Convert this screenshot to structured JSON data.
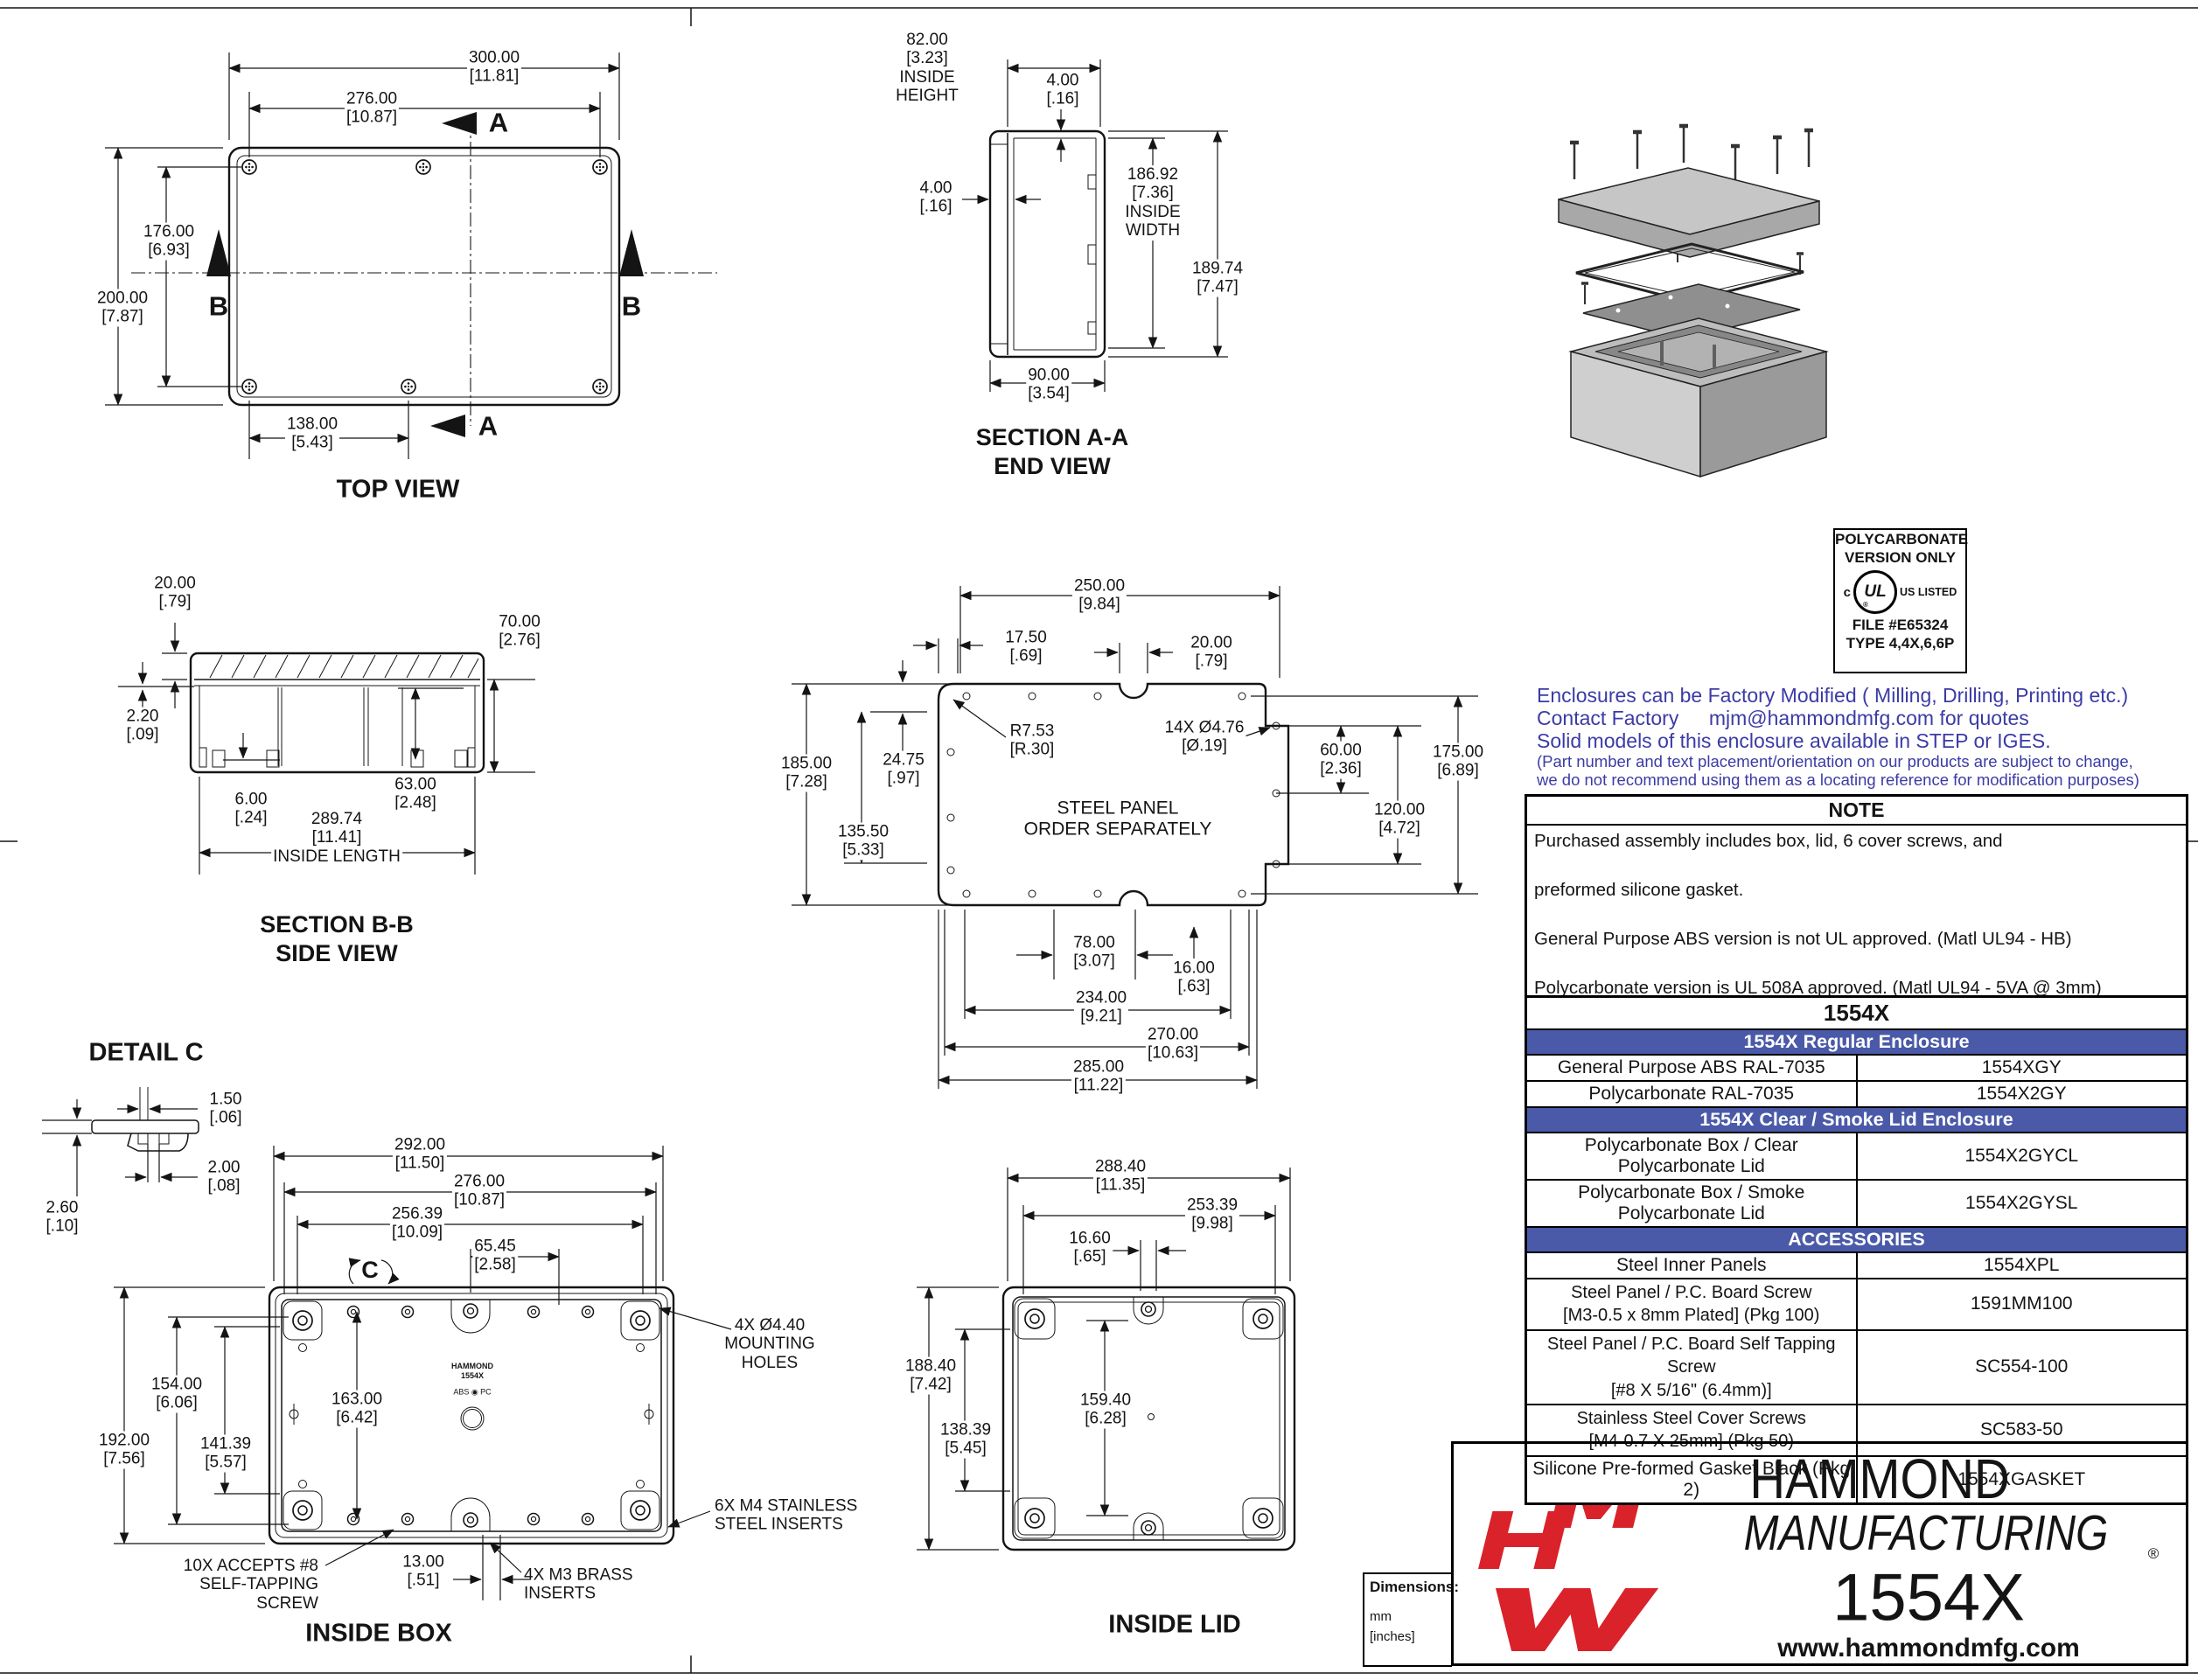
{
  "colors": {
    "line": "#141414",
    "table_header_blue": "#4a5aa8",
    "factory_text_blue": "#3b3ba6",
    "logo_red": "#d9222a"
  },
  "top_view": {
    "label": "TOP VIEW",
    "mark_a": "A",
    "mark_b": "B",
    "dim_300": "300.00\n[11.81]",
    "dim_276": "276.00\n[10.87]",
    "dim_200": "200.00\n[7.87]",
    "dim_176": "176.00\n[6.93]",
    "dim_138": "138.00\n[5.43]"
  },
  "section_aa": {
    "label1": "SECTION A-A",
    "label2": "END VIEW",
    "dim_inside_height": "82.00\n[3.23]\nINSIDE\nHEIGHT",
    "dim_wall_top": "4.00\n[.16]",
    "dim_wall_side": "4.00\n[.16]",
    "dim_inside_width": "186.92\n[7.36]\nINSIDE\nWIDTH",
    "dim_overall_width": "189.74\n[7.47]",
    "dim_depth": "90.00\n[3.54]"
  },
  "section_bb": {
    "label1": "SECTION B-B",
    "label2": "SIDE VIEW",
    "dim_lid": "20.00\n[.79]",
    "dim_gasket": "2.20\n[.09]",
    "dim_box_height": "70.00\n[2.76]",
    "dim_floor": "6.00\n[.24]",
    "dim_inner_height": "63.00\n[2.48]",
    "dim_inside_length": "289.74\n[11.41]\nINSIDE LENGTH"
  },
  "steel_panel": {
    "note": "STEEL PANEL\nORDER SEPARATELY",
    "dim_250": "250.00\n[9.84]",
    "dim_17_5": "17.50\n[.69]",
    "dim_20": "20.00\n[.79]",
    "dim_radius": "R7.53\n[R.30]",
    "dim_holes": "14X Ø4.76\n[Ø.19]",
    "dim_185": "185.00\n[7.28]",
    "dim_24_75": "24.75\n[.97]",
    "dim_135_5": "135.50\n[5.33]",
    "dim_60": "60.00\n[2.36]",
    "dim_175": "175.00\n[6.89]",
    "dim_120": "120.00\n[4.72]",
    "dim_78": "78.00\n[3.07]",
    "dim_16": "16.00\n[.63]",
    "dim_234": "234.00\n[9.21]",
    "dim_270": "270.00\n[10.63]",
    "dim_285": "285.00\n[11.22]"
  },
  "detail_c": {
    "label": "DETAIL  C",
    "dim_1_5": "1.50\n[.06]",
    "dim_2": "2.00\n[.08]",
    "dim_2_6": "2.60\n[.10]"
  },
  "inside_box": {
    "label": "INSIDE BOX",
    "mark_c": "C",
    "brand": "HAMMOND\n1554X",
    "material": "ABS ◉ PC",
    "dim_292": "292.00\n[11.50]",
    "dim_276": "276.00\n[10.87]",
    "dim_256": "256.39\n[10.09]",
    "dim_65": "65.45\n[2.58]",
    "dim_154": "154.00\n[6.06]",
    "dim_192": "192.00\n[7.56]",
    "dim_141": "141.39\n[5.57]",
    "dim_163": "163.00\n[6.42]",
    "dim_13": "13.00\n[.51]",
    "callout_mounting": "4X Ø4.40\nMOUNTING\nHOLES",
    "callout_m4_inserts": "6X M4 STAINLESS\nSTEEL INSERTS",
    "callout_self_tapping": "10X ACCEPTS #8\nSELF-TAPPING\nSCREW",
    "callout_m3_inserts": "4X M3 BRASS\nINSERTS"
  },
  "inside_lid": {
    "label": "INSIDE LID",
    "dim_288": "288.40\n[11.35]",
    "dim_253": "253.39\n[9.98]",
    "dim_16_6": "16.60\n[.65]",
    "dim_188": "188.40\n[7.42]",
    "dim_138": "138.39\n[5.45]",
    "dim_159": "159.40\n[6.28]"
  },
  "ul_box": {
    "line1": "POLYCARBONATE",
    "line2": "VERSION ONLY",
    "c": "c",
    "ul": "UL",
    "reg": "®",
    "us_listed": "US LISTED",
    "file": "FILE #E65324",
    "type": "TYPE 4,4X,6,6P"
  },
  "factory_note": {
    "line1": "Enclosures can be Factory Modified ( Milling, Drilling, Printing etc.)",
    "line2": "Contact Factory  mjm@hammondmfg.com for quotes",
    "line3": "Solid models of this enclosure available in STEP or IGES.",
    "line4": "(Part number and text placement/orientation on our products are subject to change,",
    "line5": "we do not recommend using them as a locating reference for modification purposes)"
  },
  "note_table": {
    "header": "NOTE",
    "line1": "Purchased  assembly includes box, lid, 6 cover screws, and",
    "line2": "preformed silicone gasket.",
    "line3": "General Purpose ABS version is not UL approved. (Matl UL94 - HB)",
    "line4": "Polycarbonate version is UL 508A approved. (Matl UL94 - 5VA  @ 3mm)",
    "footer": "Recommended Cover screw torque -- 8-9 lbf-in (90-100 cN-m)"
  },
  "parts_table": {
    "title": "1554X",
    "rows": [
      {
        "label": "1554X Regular Enclosure"
      },
      {
        "label": "General Purpose ABS RAL-7035",
        "part": "1554XGY"
      },
      {
        "label": "Polycarbonate RAL-7035",
        "part": "1554X2GY"
      },
      {
        "label": "1554X Clear / Smoke Lid Enclosure"
      },
      {
        "label": "Polycarbonate Box / Clear Polycarbonate Lid",
        "part": "1554X2GYCL"
      },
      {
        "label": "Polycarbonate Box / Smoke Polycarbonate Lid",
        "part": "1554X2GYSL"
      },
      {
        "label": "ACCESSORIES"
      },
      {
        "label": "Steel Inner Panels",
        "part": "1554XPL"
      },
      {
        "label": "Steel Panel / P.C. Board Screw\n[M3-0.5 x 8mm Plated]  (Pkg 100)",
        "part": "1591MM100"
      },
      {
        "label": "Steel Panel / P.C. Board Self Tapping Screw\n[#8 X 5/16\" (6.4mm)]",
        "part": "SC554-100"
      },
      {
        "label": "Stainless Steel Cover Screws\n[M4-0.7 X 25mm] (Pkg 50)",
        "part": "SC583-50"
      },
      {
        "label": "Silicone Pre-formed Gasket Black (Pkg 2)",
        "part": "1554XGASKET"
      }
    ]
  },
  "dims_box": {
    "title": "Dimensions:",
    "unit1": "mm",
    "unit2": "[inches]"
  },
  "footer": {
    "brand_line1": "HAMMOND",
    "brand_line2": "MANUFACTURING",
    "reg": "®",
    "product": "1554X",
    "website": "www.hammondmfg.com"
  }
}
